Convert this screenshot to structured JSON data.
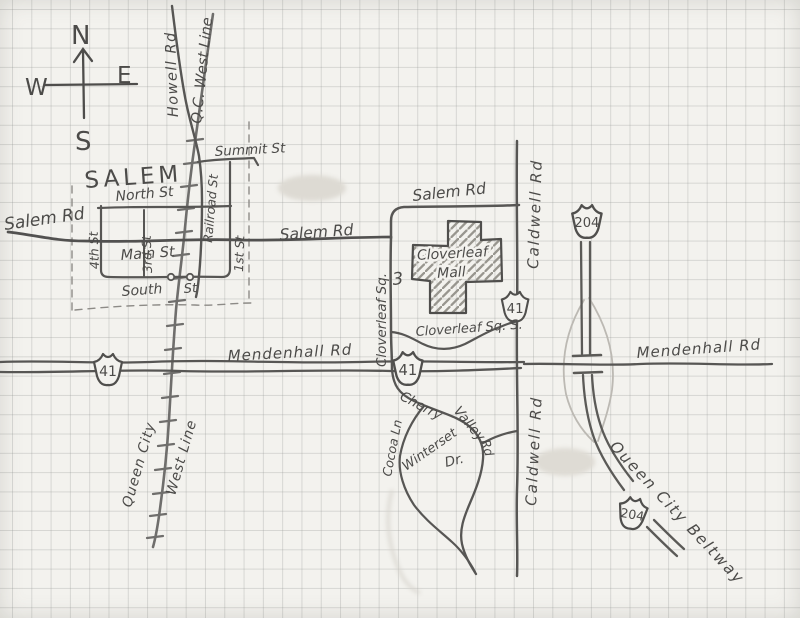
{
  "map": {
    "region_label": "SALEM",
    "compass": {
      "north": "N",
      "south": "S",
      "west": "W",
      "east": "E"
    },
    "roads": {
      "salem_rd": "Salem Rd",
      "summit_st": "Summit St",
      "north_st": "North St",
      "main_st": "Main St",
      "south_st": {
        "word1": "South",
        "word2": "St"
      },
      "first_st": "1st St",
      "third_st": "3rd St",
      "fourth_st": "4th St",
      "railroad_st": "Railroad St",
      "howell_rd": "Howell Rd",
      "mendenhall_rd": "Mendenhall Rd",
      "caldwell_rd": "Caldwell Rd",
      "cloverleaf_sq": "Cloverleaf Sq.",
      "cloverleaf_sq_s": "Cloverleaf Sq. S.",
      "cherry_valley_rd": {
        "word1": "Cherry",
        "word2": "Valley",
        "word3": "Rd"
      },
      "winterset_dr": {
        "word1": "Winterset",
        "word2": "Dr."
      },
      "cocoa_ln": "Cocoa Ln",
      "queen_city_beltway": "Queen City Beltway"
    },
    "railway": {
      "qc_west_line": "Q.C. West Line",
      "queen_city_west_line": {
        "line1": "Queen City",
        "line2": "West Line"
      }
    },
    "landmarks": {
      "cloverleaf_mall": {
        "line1": "Cloverleaf",
        "line2": "Mall"
      }
    },
    "route_shields": {
      "route_41": "41",
      "route_204": "204"
    },
    "annotations": {
      "block_number": "3"
    }
  }
}
